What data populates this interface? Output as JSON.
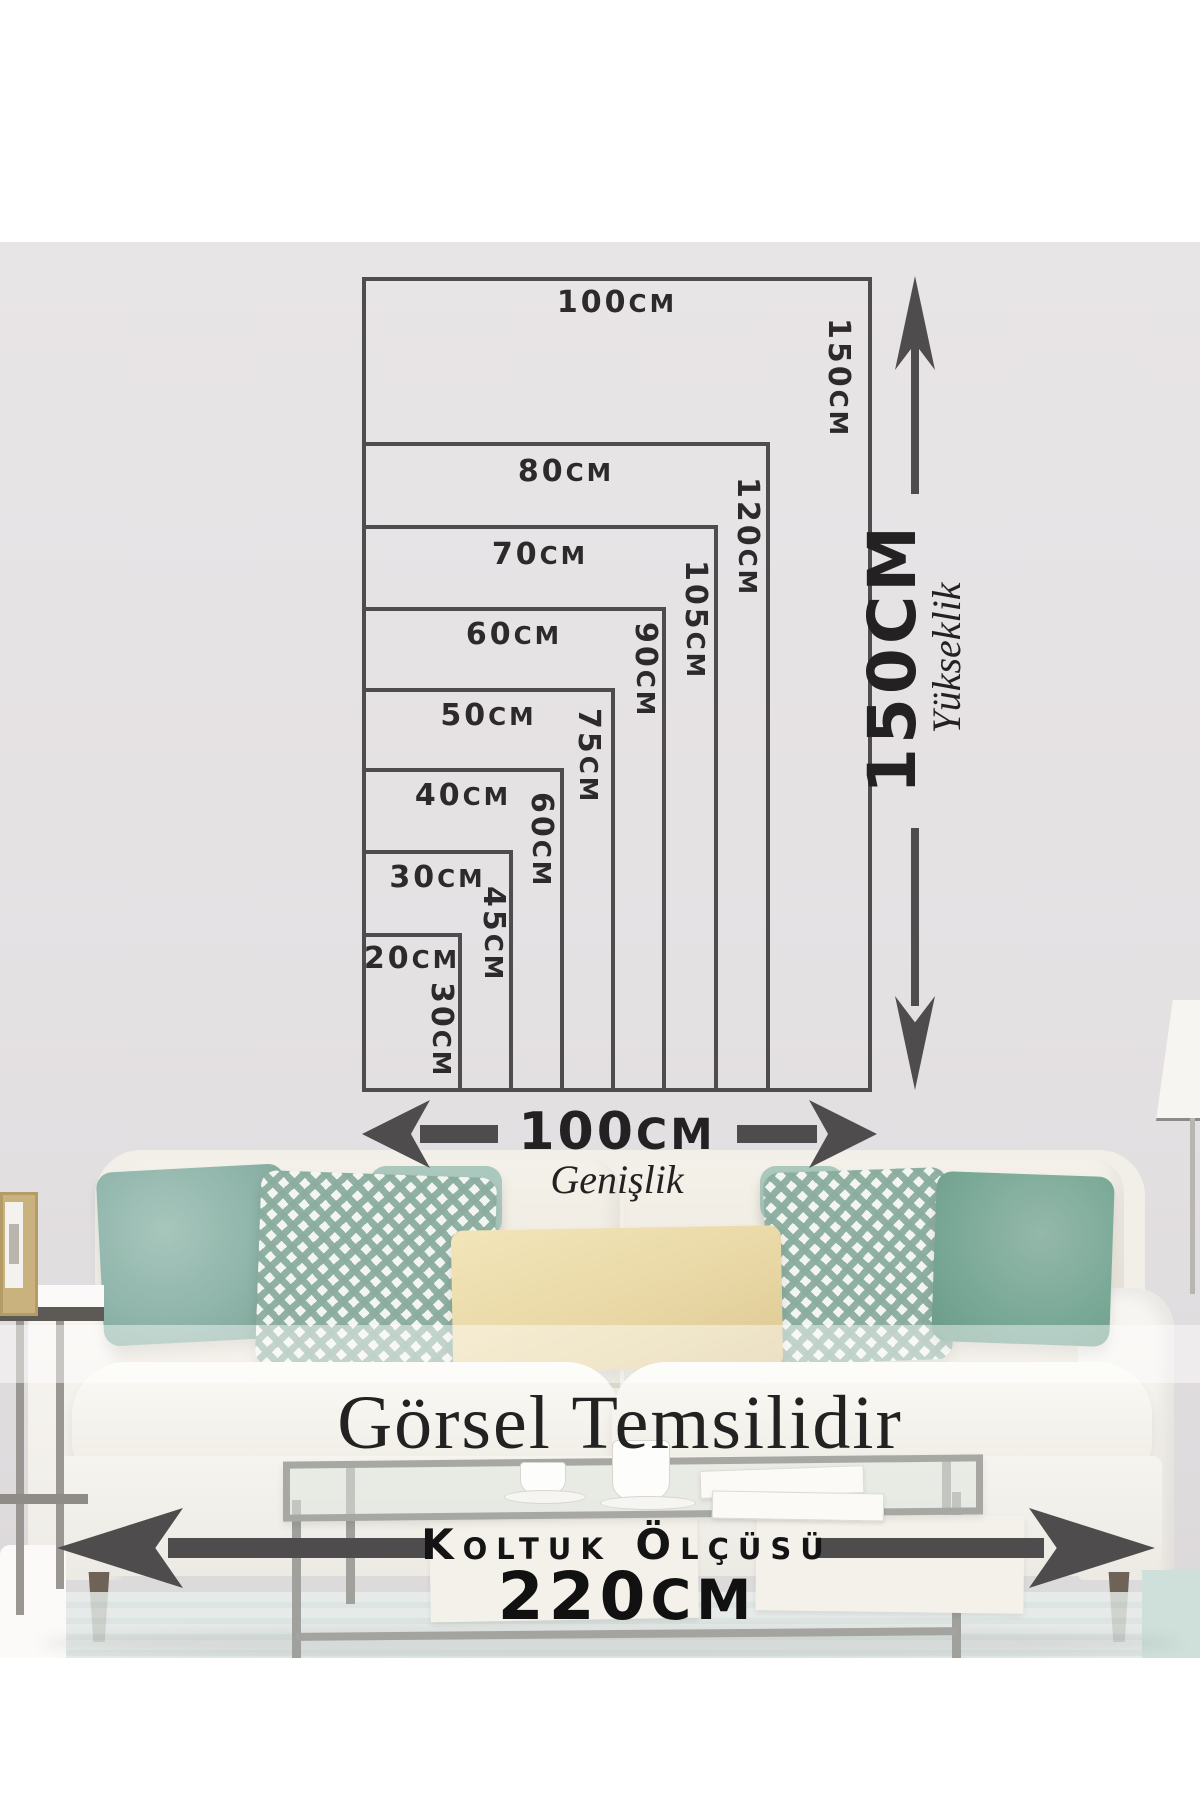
{
  "size_diagram": {
    "sizes": [
      {
        "width": "20CM",
        "height": "30CM"
      },
      {
        "width": "30CM",
        "height": "45CM"
      },
      {
        "width": "40CM",
        "height": "60CM"
      },
      {
        "width": "50CM",
        "height": "75CM"
      },
      {
        "width": "60CM",
        "height": "90CM"
      },
      {
        "width": "70CM",
        "height": "105CM"
      },
      {
        "width": "80CM",
        "height": "120CM"
      },
      {
        "width": "100CM",
        "height": "150CM"
      }
    ],
    "width_axis": {
      "value": "100CM",
      "label": "Genişlik"
    },
    "height_axis": {
      "value": "150CM",
      "label": "Yükseklik"
    }
  },
  "captions": {
    "disclaimer": "Görsel Temsilidir",
    "sofa_measure_label": "Koltuk Ölçüsü",
    "sofa_measure_value_number": "220",
    "sofa_measure_value_unit": "CM"
  },
  "colors": {
    "diagram_line": "#4e4c4d",
    "label_text": "#2c2a2b",
    "wall": "#e4e1e3",
    "teal_pillow_light": "#8db3a8",
    "teal_pillow_dark": "#79a897",
    "diamond_pattern_teal": "#8badA0",
    "cream_pillow": "#e9d8a6"
  }
}
